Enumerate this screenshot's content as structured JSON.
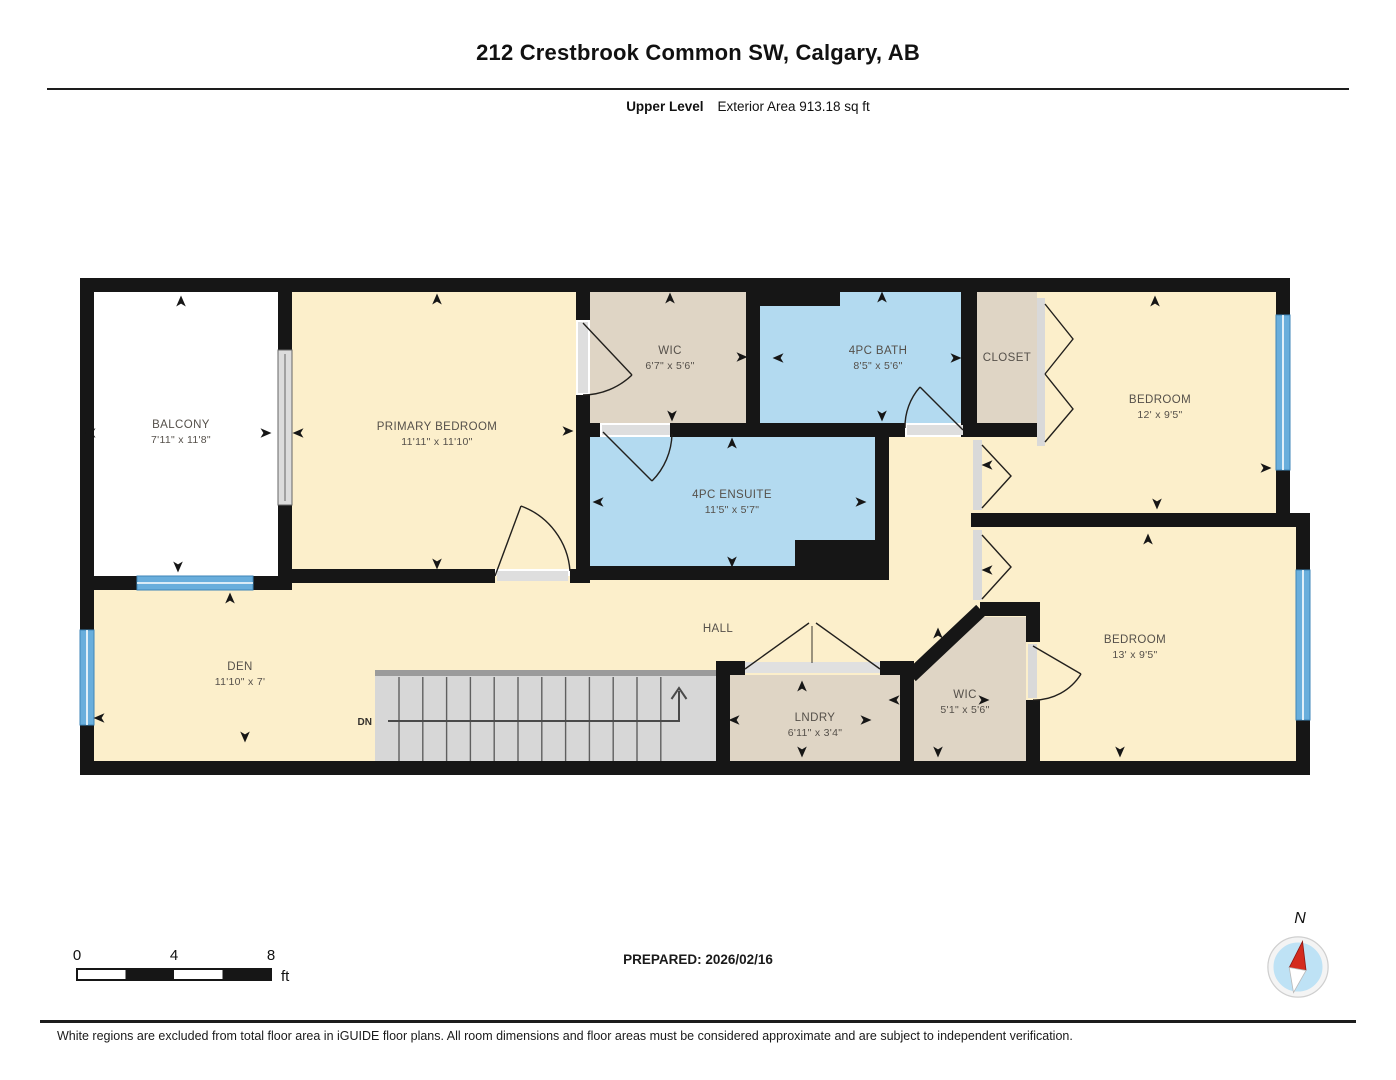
{
  "header": {
    "title": "212 Crestbrook Common SW, Calgary, AB",
    "level_label": "Upper Level",
    "area_label": "Exterior Area 913.18 sq ft"
  },
  "floorplan": {
    "rooms": [
      {
        "name": "BALCONY",
        "dims": "7'11\" x 11'8\""
      },
      {
        "name": "PRIMARY BEDROOM",
        "dims": "11'11\" x 11'10\""
      },
      {
        "name": "WIC",
        "dims": "6'7\" x 5'6\""
      },
      {
        "name": "4PC BATH",
        "dims": "8'5\" x 5'6\""
      },
      {
        "name": "CLOSET",
        "dims": ""
      },
      {
        "name": "BEDROOM",
        "dims": "12' x 9'5\""
      },
      {
        "name": "4PC ENSUITE",
        "dims": "11'5\" x 5'7\""
      },
      {
        "name": "HALL",
        "dims": ""
      },
      {
        "name": "DEN",
        "dims": "11'10\" x 7'"
      },
      {
        "name": "LNDRY",
        "dims": "6'11\" x 3'4\""
      },
      {
        "name": "WIC",
        "dims": "5'1\" x 5'6\""
      },
      {
        "name": "BEDROOM",
        "dims": "13' x 9'5\""
      }
    ],
    "stairs_label": "DN",
    "colors": {
      "floor_cream": "#FCEFCB",
      "wet_blue": "#B3DAF0",
      "closet_tan": "#DFD5C5",
      "balcony_white": "#FFFFFF",
      "wall_black": "#161616",
      "window_blue": "#69AEDC",
      "stairs_gray": "#D7D7D7"
    }
  },
  "footer": {
    "scale": {
      "ticks": [
        "0",
        "4",
        "8"
      ],
      "unit": "ft"
    },
    "prepared_label": "PREPARED: 2026/02/16",
    "compass_label": "N",
    "disclaimer": "White regions are excluded from total floor area in iGUIDE floor plans. All room dimensions and floor areas must be considered approximate and are subject to independent verification."
  }
}
